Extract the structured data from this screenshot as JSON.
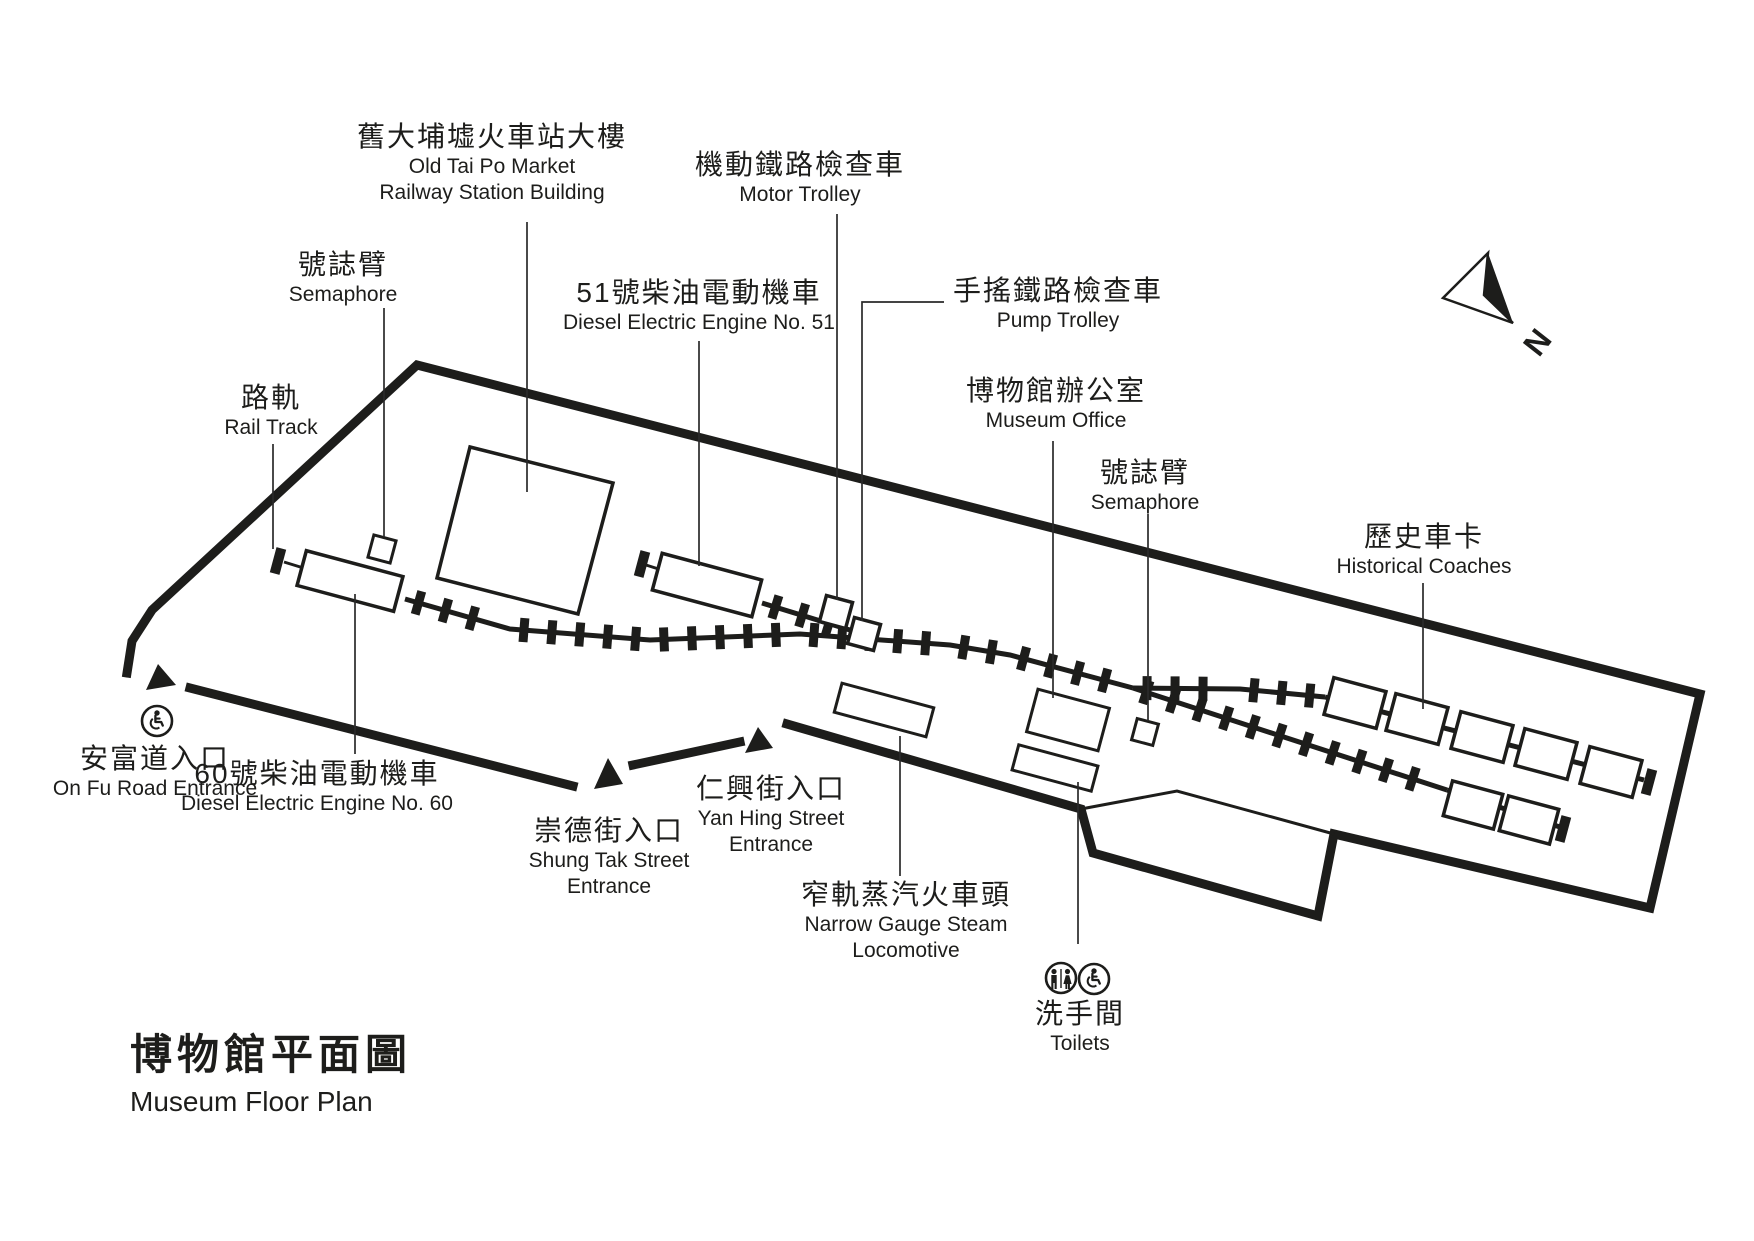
{
  "title": {
    "cjk": "博物館平面圖",
    "en": "Museum Floor Plan"
  },
  "north_indicator": {
    "label": "N"
  },
  "colors": {
    "ink": "#1d1d1b",
    "background": "#ffffff"
  },
  "features": {
    "station_building": {
      "cjk": "舊大埔墟火車站大樓",
      "en1": "Old Tai Po Market",
      "en2": "Railway Station Building"
    },
    "motor_trolley": {
      "cjk": "機動鐵路檢查車",
      "en1": "Motor Trolley"
    },
    "semaphore_west": {
      "cjk": "號誌臂",
      "en1": "Semaphore"
    },
    "engine_51": {
      "cjk": "51號柴油電動機車",
      "en1": "Diesel Electric Engine No. 51"
    },
    "pump_trolley": {
      "cjk": "手搖鐵路檢查車",
      "en1": "Pump Trolley"
    },
    "rail_track": {
      "cjk": "路軌",
      "en1": "Rail Track"
    },
    "museum_office": {
      "cjk": "博物館辦公室",
      "en1": "Museum Office"
    },
    "semaphore_east": {
      "cjk": "號誌臂",
      "en1": "Semaphore"
    },
    "historical_coaches": {
      "cjk": "歷史車卡",
      "en1": "Historical Coaches"
    },
    "on_fu_road_entrance": {
      "cjk": "安富道入口",
      "en1": "On Fu Road Entrance"
    },
    "engine_60": {
      "cjk": "60號柴油電動機車",
      "en1": "Diesel Electric Engine No. 60"
    },
    "shung_tak_street_entrance": {
      "cjk": "崇德街入口",
      "en1": "Shung Tak Street",
      "en2": "Entrance"
    },
    "yan_hing_street_entrance": {
      "cjk": "仁興街入口",
      "en1": "Yan Hing Street",
      "en2": "Entrance"
    },
    "narrow_gauge_steam_locomotive": {
      "cjk": "窄軌蒸汽火車頭",
      "en1": "Narrow Gauge Steam",
      "en2": "Locomotive"
    },
    "toilets": {
      "cjk": "洗手間",
      "en1": "Toilets"
    }
  },
  "icons": {
    "north_arrow": "compass-north-arrow",
    "on_fu_accessibility": "wheelchair-icon",
    "toilets_genders": "male-female-icon",
    "toilets_accessibility": "wheelchair-icon"
  }
}
